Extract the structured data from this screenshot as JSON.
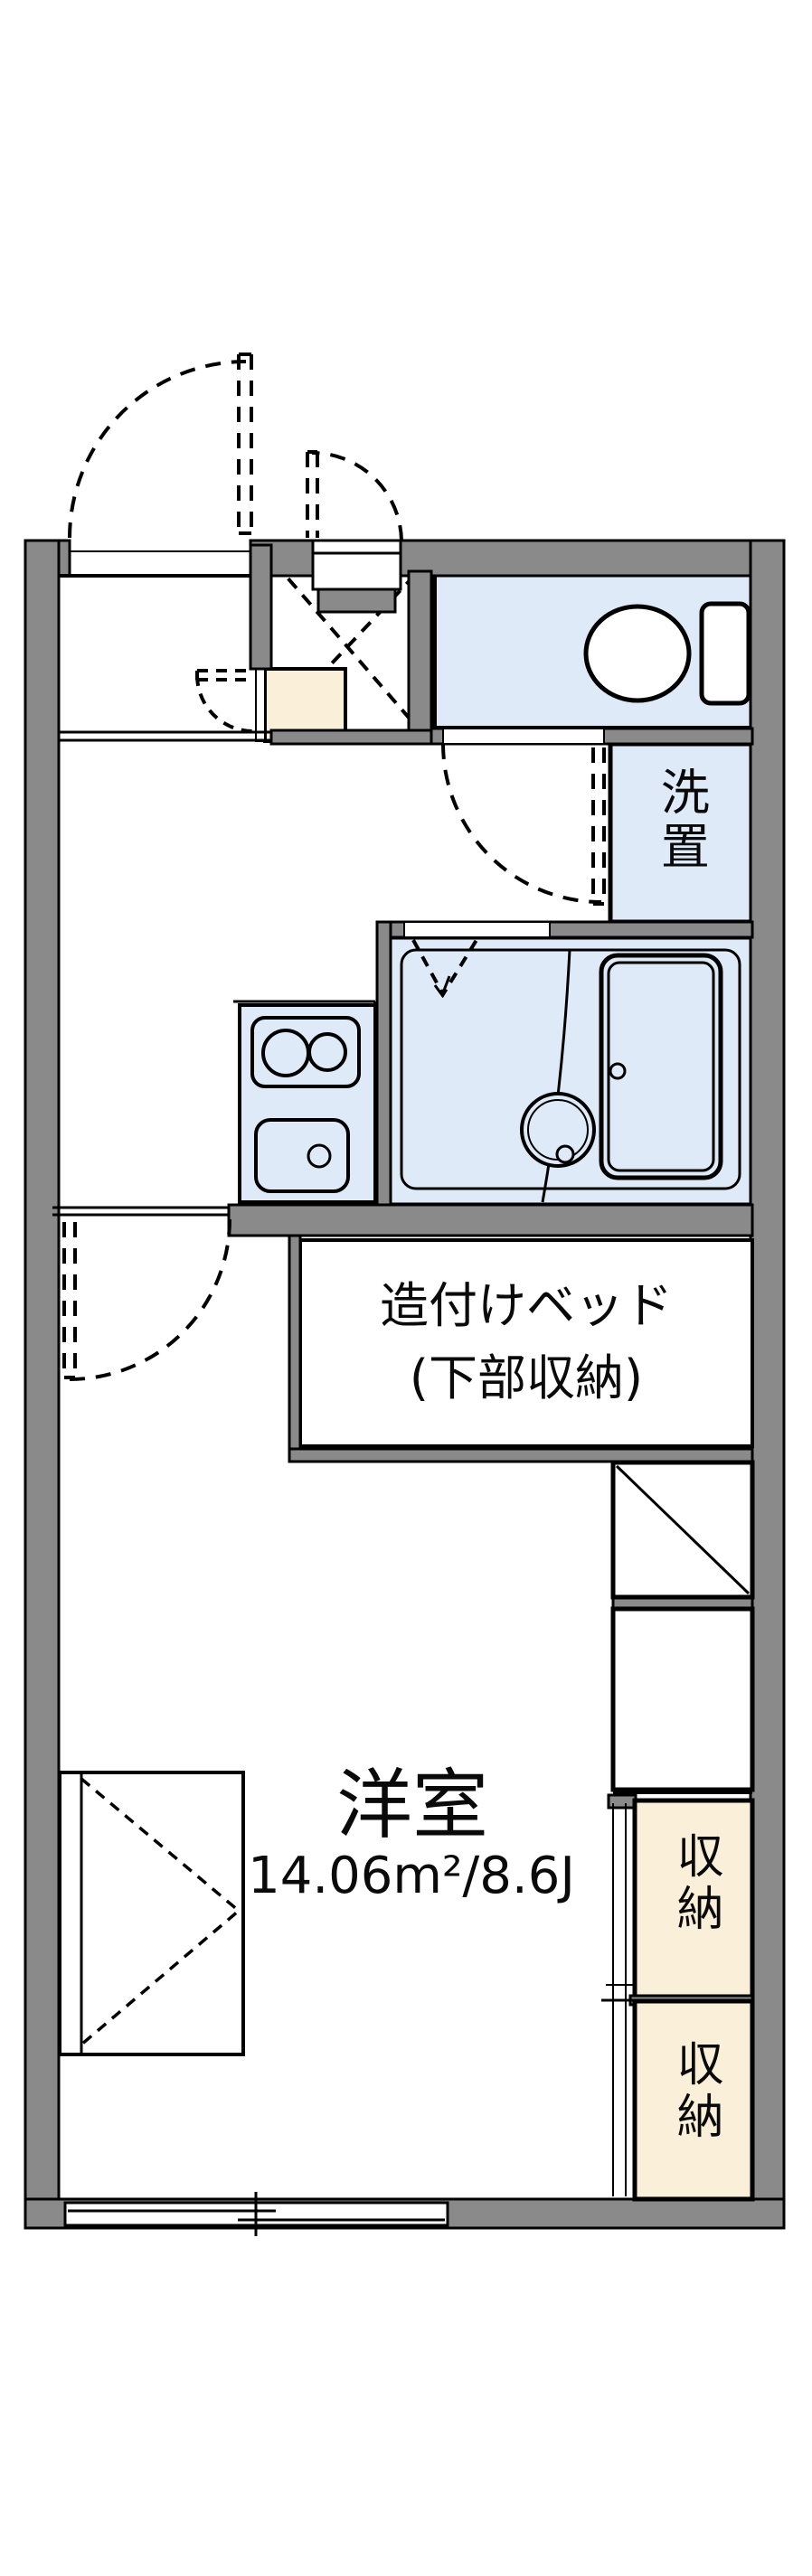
{
  "floorplan": {
    "labels": {
      "laundry": "洗置",
      "bed_line1": "造付けベッド",
      "bed_line2": "(下部収納)",
      "room_name": "洋室",
      "room_area": "14.06m²/8.6J",
      "storage_top": "収納",
      "storage_bottom": "収納"
    },
    "colors": {
      "wall": "#8a8a8a",
      "wet_room": "#dfeaf8",
      "storage_fill": "#faf0da",
      "line": "#000000",
      "background": "#ffffff"
    }
  }
}
